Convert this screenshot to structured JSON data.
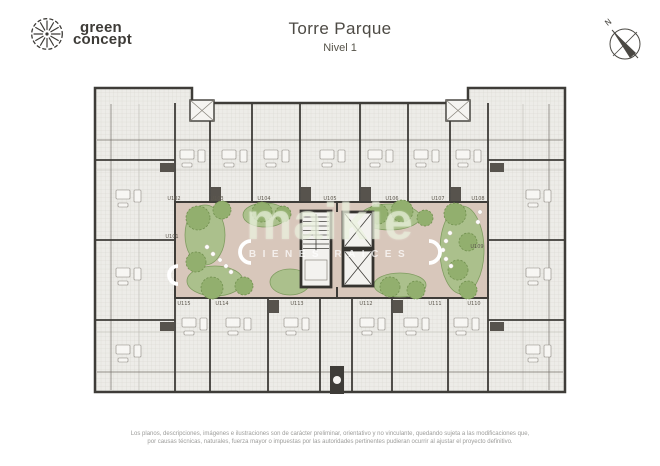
{
  "header": {
    "logo": {
      "line1": "green",
      "line2": "concept"
    },
    "title": "Torre Parque",
    "subtitle": "Nivel 1",
    "compass_label": "N"
  },
  "watermark": {
    "brand": "maikie",
    "tagline": "BIENES RAICES"
  },
  "plan": {
    "units_top": [
      "U102",
      "U103",
      "U104",
      "U105",
      "U106",
      "U107",
      "U108"
    ],
    "unit_left": "U101",
    "unit_right": "U109",
    "units_bottom": [
      "U115",
      "U114",
      "U113",
      "U112",
      "U111",
      "U110"
    ]
  },
  "footer": {
    "line1": "Los planos, descripciones, imágenes e ilustraciones son de carácter preliminar, orientativo y no vinculante, quedando sujeta a las modificaciones que,",
    "line2": "por causas técnicas, naturales, fuerza mayor o impuestas por las autoridades pertinentes pudieran ocurrir al ajustar el proyecto definitivo."
  },
  "colors": {
    "wall": "#3e3c38",
    "floor_hatch": "#edece8",
    "courtyard": "#d8c7bb",
    "planting": "#abc08c",
    "tree": "#92af6e",
    "label_text": "#5e594f"
  }
}
